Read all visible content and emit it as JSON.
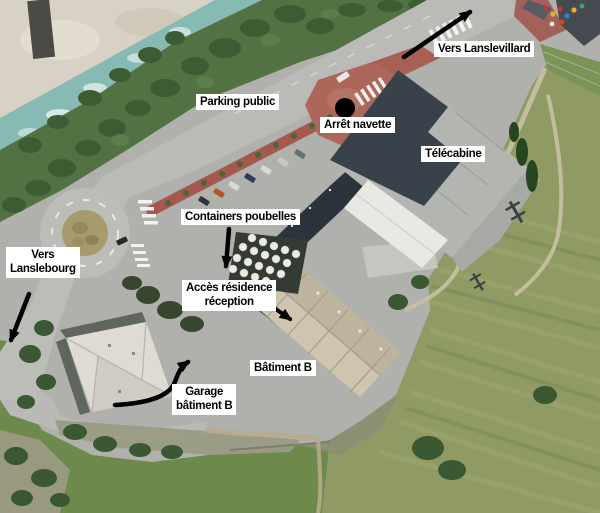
{
  "annotations": {
    "labels": [
      {
        "id": "vers-lanslevillard",
        "text": "Vers Lanslevillard"
      },
      {
        "id": "parking-public",
        "text": "Parking public"
      },
      {
        "id": "arret-navette",
        "text": "Arrêt navette"
      },
      {
        "id": "telecabine",
        "text": "Télécabine"
      },
      {
        "id": "containers-poubelles",
        "text": "Containers poubelles"
      },
      {
        "id": "vers-lanslebourg",
        "text": "Vers\nLanslebourg"
      },
      {
        "id": "acces-residence",
        "text": "Accès résidence\nréception"
      },
      {
        "id": "batiment-b",
        "text": "Bâtiment B"
      },
      {
        "id": "garage-batiment-b",
        "text": "Garage\nbâtiment B"
      }
    ],
    "markers": [
      {
        "id": "arret-navette-dot",
        "shape": "filled-circle",
        "color": "#000000"
      }
    ],
    "arrows": [
      {
        "id": "arrow-vers-lanslevillard",
        "label": "vers-lanslevillard"
      },
      {
        "id": "arrow-vers-lanslebourg",
        "label": "vers-lanslebourg"
      },
      {
        "id": "arrow-containers",
        "label": "containers-poubelles"
      },
      {
        "id": "arrow-acces-residence",
        "label": "acces-residence"
      },
      {
        "id": "arrow-garage",
        "label": "garage-batiment-b"
      }
    ]
  },
  "colors": {
    "label_background": "#ffffff",
    "label_text": "#000000",
    "annotation_ink": "#000000",
    "asphalt": "#b0b1ad",
    "road": "#babbb6",
    "red_walkway": "#a5594e",
    "red_plaza": "#ac675a",
    "grass": "#6d8a4c",
    "field": "#8f9a64",
    "water": "#88bab4",
    "gravel": "#d7d2c5",
    "roof_gray": "#b3b5b1",
    "roof_white": "#e9e9e4",
    "roof_beige": "#c9bfa9",
    "roof_dark": "#2b333c"
  }
}
